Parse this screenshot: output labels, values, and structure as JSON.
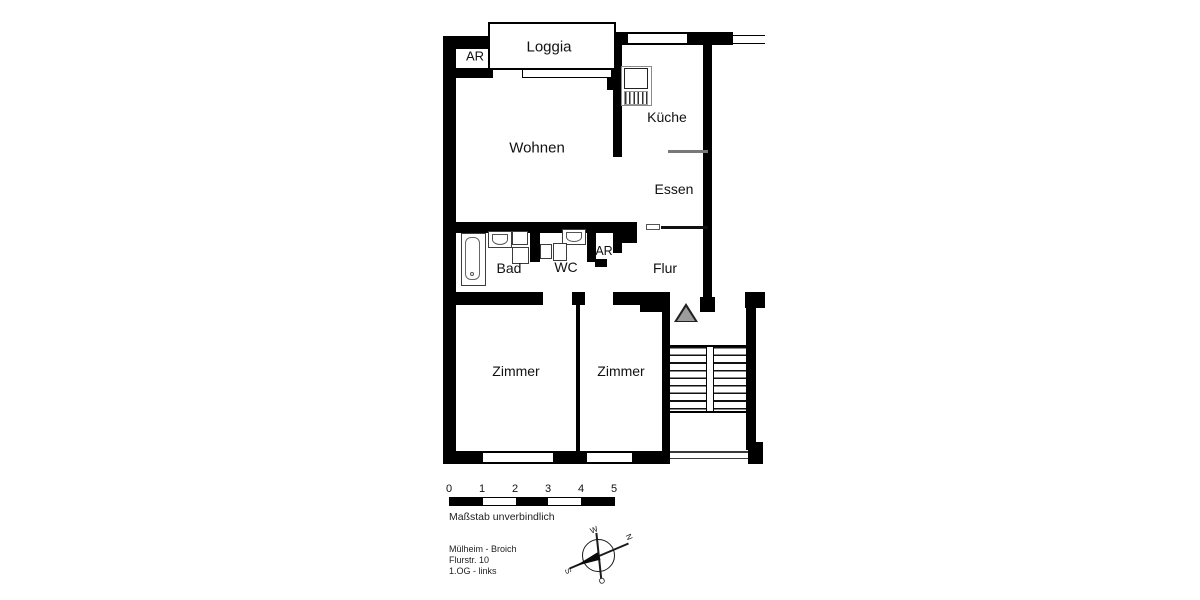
{
  "rooms": {
    "loggia": "Loggia",
    "storage_top": "AR",
    "living": "Wohnen",
    "kitchen": "Küche",
    "dining": "Essen",
    "bath": "Bad",
    "wc": "WC",
    "storage_mid": "AR",
    "hall": "Flur",
    "room_left": "Zimmer",
    "room_right": "Zimmer"
  },
  "scale_bar": {
    "ticks": [
      "0",
      "1",
      "2",
      "3",
      "4",
      "5"
    ],
    "caption": "Maßstab unverbindlich"
  },
  "address": {
    "line1": "Mülheim - Broich",
    "line2": "Flurstr. 10",
    "line3": "1.OG - links"
  },
  "compass": {
    "north": "N",
    "east": "O",
    "south": "S",
    "west": "W"
  },
  "colors": {
    "wall": "#000000",
    "background": "#ffffff",
    "entrance_marker": "#9c9c9c",
    "counter_line": "#787878"
  }
}
